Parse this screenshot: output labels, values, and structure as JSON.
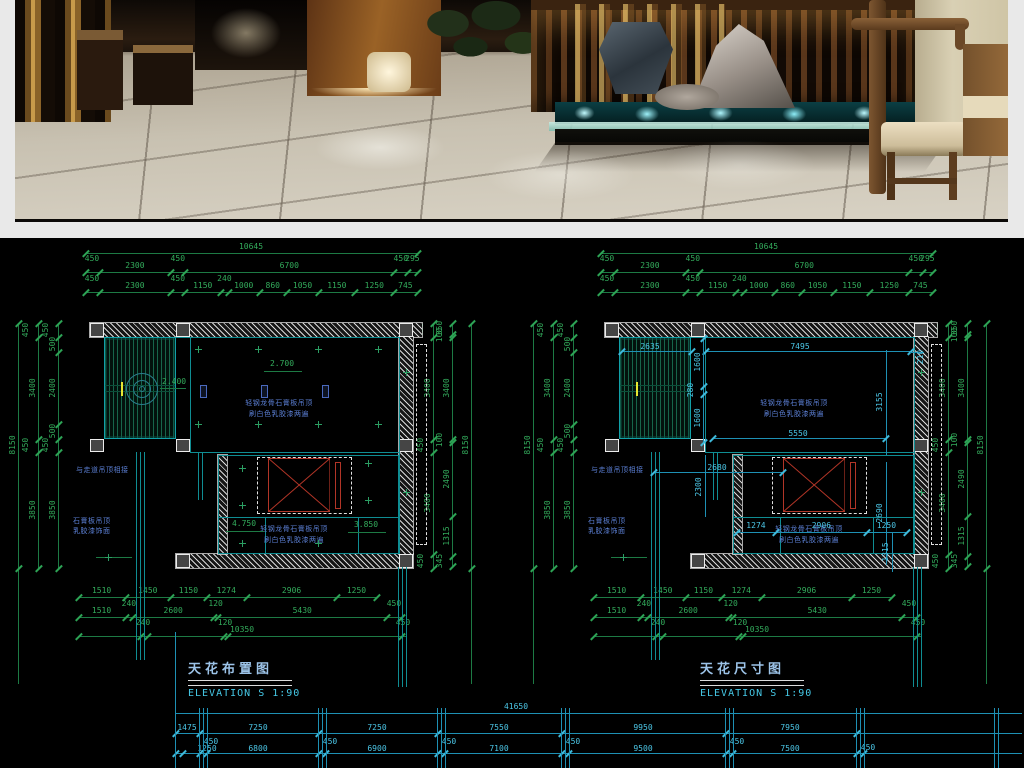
{
  "colors": {
    "dim_green": "#33ac5c",
    "dim_cyan": "#4cc6e6",
    "plan_teal": "#0f8d93",
    "note_blue": "#5b7fd4",
    "symbol_red": "#b23527",
    "title_blue": "#9cc3e8",
    "elevation_cyan": "#46cae8",
    "cad_bg": "#000000",
    "page_bg": "#e9e9e9"
  },
  "photo": {
    "description": "Chinese restaurant interior render with wooden lattice screen, water feature, stone and tiled floor"
  },
  "plans": [
    {
      "title_cn": "天花布置图",
      "title_en": "ELEVATION S 1:90",
      "top_r1": [
        "10645"
      ],
      "top_r2": [
        "450",
        "2300",
        "450",
        "6700",
        "450",
        "295"
      ],
      "top_r3": [
        "450",
        "2300",
        "450",
        "1150",
        "240",
        "1000",
        "860",
        "1050",
        "1150",
        "1250",
        "745"
      ],
      "left_a": [
        "8150"
      ],
      "left_b": [
        "450",
        "3400",
        "450",
        "3850"
      ],
      "left_c": [
        "450",
        "500",
        "2400",
        "500",
        "450",
        "3850"
      ],
      "right_d": [
        "450",
        "3400",
        "450",
        "3400",
        "450"
      ],
      "right_e": [
        "350",
        "100",
        "3400",
        "100",
        "2490",
        "1315",
        "345"
      ],
      "right_f": [
        "8150"
      ],
      "bot_r1": [
        "1510",
        "1450",
        "1150",
        "1274",
        "2906",
        "1250"
      ],
      "bot_r2": [
        "1510",
        "240",
        "2600",
        "120",
        "5430",
        "450"
      ],
      "bot_r3": [
        "240",
        "120",
        "10350",
        "450"
      ],
      "levels": {
        "hall": "2.700",
        "slat": "2.400",
        "low_left": "4.750",
        "low_right": "3.850"
      },
      "notes": {
        "hall": [
          "轻钢龙骨石膏板吊顶",
          "刷白色乳胶漆两遍"
        ],
        "lower": [
          "轻钢龙骨石膏板吊顶",
          "刷白色乳胶漆两遍"
        ],
        "side_a": "与走道吊顶相接",
        "side_b": [
          "石膏板吊顶",
          "乳胶漆饰面"
        ]
      }
    },
    {
      "title_cn": "天花尺寸图",
      "title_en": "ELEVATION S 1:90",
      "top_r1": [
        "10645"
      ],
      "top_r2": [
        "450",
        "2300",
        "450",
        "6700",
        "450",
        "295"
      ],
      "top_r3": [
        "450",
        "2300",
        "450",
        "1150",
        "240",
        "1000",
        "860",
        "1050",
        "1150",
        "1250",
        "745"
      ],
      "left_a": [
        "8150"
      ],
      "left_b": [
        "450",
        "3400",
        "450",
        "3850"
      ],
      "left_c": [
        "450",
        "500",
        "2400",
        "500",
        "450",
        "3850"
      ],
      "right_d": [
        "450",
        "3400",
        "450",
        "3400",
        "450"
      ],
      "right_e": [
        "350",
        "100",
        "3400",
        "100",
        "2490",
        "1315",
        "345"
      ],
      "right_f": [
        "8150"
      ],
      "bot_r1": [
        "1510",
        "1450",
        "1150",
        "1274",
        "2906",
        "1250"
      ],
      "bot_r2": [
        "1510",
        "240",
        "2600",
        "120",
        "5430",
        "450"
      ],
      "bot_r3": [
        "240",
        "120",
        "10350",
        "450"
      ],
      "interior": {
        "slat_w": "2635",
        "hall_w": "7495",
        "left_col": [
          "1600",
          "280",
          "1600"
        ],
        "right_upper": "3155",
        "right_lower": "2690",
        "corner": "210",
        "mid_w": "5550",
        "walk_w": "2680",
        "low_v": "2300",
        "low_row": [
          "1274",
          "2906",
          "1250"
        ],
        "low_v2": "1315"
      },
      "notes": {
        "hall": [
          "轻钢龙骨石膏板吊顶",
          "刷白色乳胶漆两遍"
        ],
        "lower": [
          "轻钢龙骨石膏板吊顶",
          "刷白色乳胶漆两遍"
        ],
        "side_a": "与走道吊顶相接",
        "side_b": [
          "石膏板吊顶",
          "乳胶漆饰面"
        ]
      }
    }
  ],
  "chain": {
    "total": "41650",
    "r2": [
      "1475",
      "7250",
      "7250",
      "7550",
      "9950",
      "7950"
    ],
    "r3_450": [
      "450",
      "450",
      "450",
      "450",
      "450",
      "450"
    ],
    "r3": [
      "1250",
      "6800",
      "6900",
      "7100",
      "9500",
      "7500"
    ]
  }
}
